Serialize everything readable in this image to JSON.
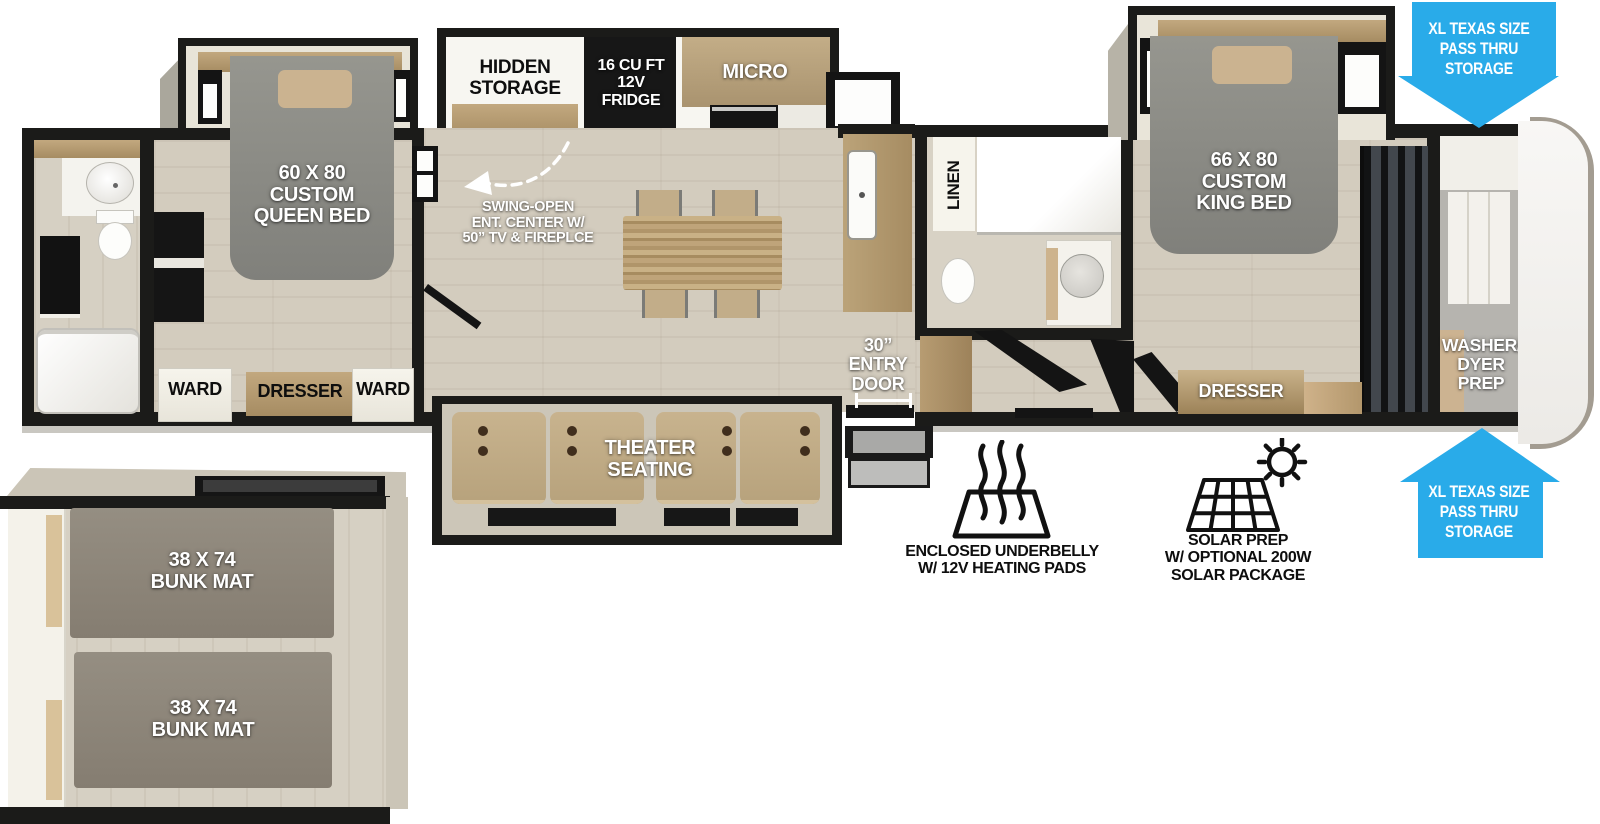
{
  "colors": {
    "accent_blue": "#29ABE9",
    "wall_black": "#1b1b19",
    "floor_beige": "#d3ccbe",
    "bed_gray": "#8a8a85",
    "cabinet_tan": "#c3ae8b",
    "wood_brown": "#b1976d"
  },
  "arrows": {
    "top": {
      "label": "XL TEXAS SIZE\nPASS THRU\nSTORAGE"
    },
    "bottom": {
      "label": "XL TEXAS SIZE\nPASS THRU\nSTORAGE"
    }
  },
  "front_bedroom": {
    "bed_label": "60 X 80\nCUSTOM\nQUEEN BED",
    "ward_left": "WARD",
    "dresser": "DRESSER",
    "ward_right": "WARD"
  },
  "kitchen": {
    "hidden_storage": "HIDDEN\nSTORAGE",
    "fridge": "16 CU FT\n12V\nFRIDGE",
    "micro": "MICRO",
    "ent_center_note": "SWING-OPEN\nENT. CENTER W/\n50” TV & FIREPLCE"
  },
  "living": {
    "theater": "THEATER\nSEATING",
    "entry_door": "30”\nENTRY\nDOOR"
  },
  "mid_bath": {
    "linen": "LINEN"
  },
  "rear_bedroom": {
    "bed_label": "66 X 80\nCUSTOM\nKING BED",
    "dresser": "DRESSER",
    "washer": "WASHER/\nDYER\nPREP"
  },
  "bunk_room": {
    "bunk_top": "38 X 74\nBUNK MAT",
    "bunk_bottom": "38 X 74\nBUNK MAT"
  },
  "features": {
    "underbelly": "ENCLOSED UNDERBELLY\nW/ 12V HEATING PADS",
    "solar": "SOLAR PREP\nW/ OPTIONAL 200W\nSOLAR PACKAGE"
  }
}
